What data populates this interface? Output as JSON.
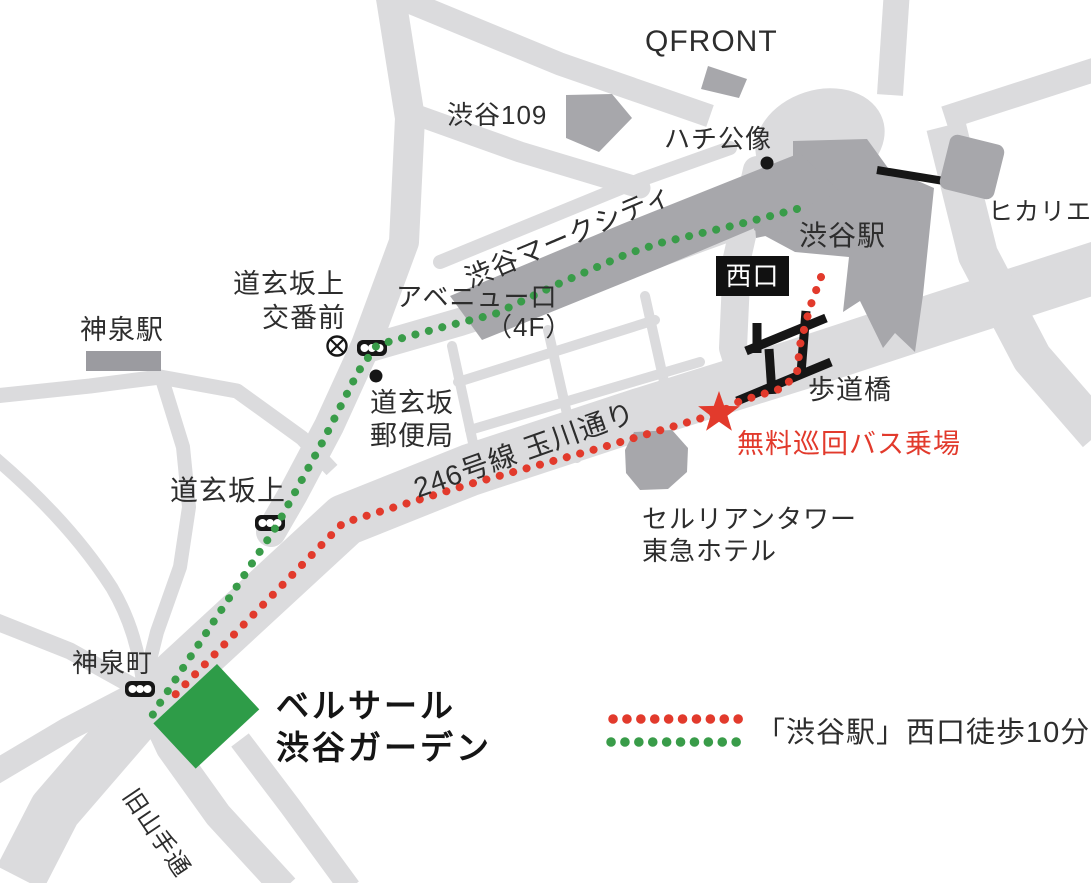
{
  "map": {
    "qfront": "QFRONT",
    "shibuya109": "渋谷109",
    "hachiko_statue": "ハチ公像",
    "mark_city": "渋谷マークシティ",
    "shibuya_station": "渋谷駅",
    "hikarie": "ヒカリエ",
    "west_exit_badge": "西口",
    "koban_line1": "道玄坂上",
    "koban_line2": "交番前",
    "avenue_line1": "アベニュー口",
    "avenue_line2": "（4F）",
    "shinsen_station": "神泉駅",
    "post_office_line1": "道玄坂",
    "post_office_line2": "郵便局",
    "footbridge": "歩道橋",
    "route_246": "246号線 玉川通り",
    "free_bus_stop": "無料巡回バス乗場",
    "cerulean_line1": "セルリアンタワー",
    "cerulean_line2": "東急ホテル",
    "dogenzaka_ue": "道玄坂上",
    "shinsencho": "神泉町",
    "venue_line1": "ベルサール",
    "venue_line2": "渋谷ガーデン",
    "kyu_yamate_dori": "旧山手通"
  },
  "legend": {
    "walk_label": "「渋谷駅」西口徒歩10分"
  },
  "icons": {
    "star": "free-shuttle-bus-stop-star",
    "koban_mark": "police-box-symbol",
    "traffic_light": "traffic-signal",
    "statue_dot": "landmark-dot",
    "post_office_dot": "landmark-dot"
  },
  "colors": {
    "road": "#dbdbdd",
    "building": "#a7a7ab",
    "venue_green": "#2e9c48",
    "route_red": "#e23a2c",
    "route_green": "#399c49",
    "badge_bg": "#111111",
    "badge_text": "#ffffff",
    "ink": "#2d2d2d"
  }
}
